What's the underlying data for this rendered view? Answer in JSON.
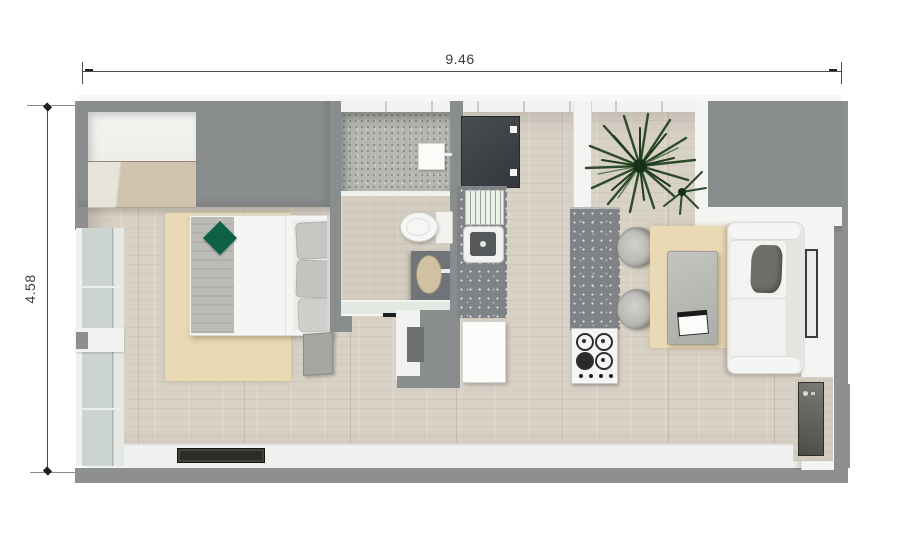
{
  "scene": {
    "type": "floor-plan-3d-top-view",
    "description": "Top-down 3D render of a studio apartment floor plan"
  },
  "dimensions": {
    "width_label": "9.46",
    "height_label": "4.58"
  },
  "colors": {
    "wall_gray": "#8e8f8f",
    "floor_wood": "#d8d1c6",
    "rug_beige": "#e9d9b4",
    "counter_speckled_gray": "#7f8387",
    "shower_speckled": "#b5b7b1",
    "fixture_white": "#f2f2f0",
    "accent_cushion_green": "#0d6147",
    "appliance_dark": "#3e4246"
  },
  "rooms": [
    {
      "name": "bedroom",
      "furniture": [
        "closet-niche",
        "double-bed",
        "gray-throw",
        "green-cushion",
        "pillows",
        "nightstand",
        "beige-rug",
        "side-windows"
      ]
    },
    {
      "name": "bathroom",
      "furniture": [
        "shower-tray",
        "shower-unit",
        "glass-partition",
        "toilet",
        "vanity-sink"
      ]
    },
    {
      "name": "kitchen",
      "furniture": [
        "refrigerator",
        "drainboard",
        "kitchen-sink",
        "counter",
        "island",
        "gas-stove"
      ]
    },
    {
      "name": "living-dining",
      "furniture": [
        "potted-palm",
        "bar-chairs",
        "coffee-table",
        "book",
        "sofa",
        "sofa-pillow",
        "beige-rug",
        "wall-radiator",
        "utility-cabinet"
      ]
    },
    {
      "name": "entry",
      "furniture": [
        "doormat",
        "open-door",
        "entry-partition"
      ]
    }
  ]
}
